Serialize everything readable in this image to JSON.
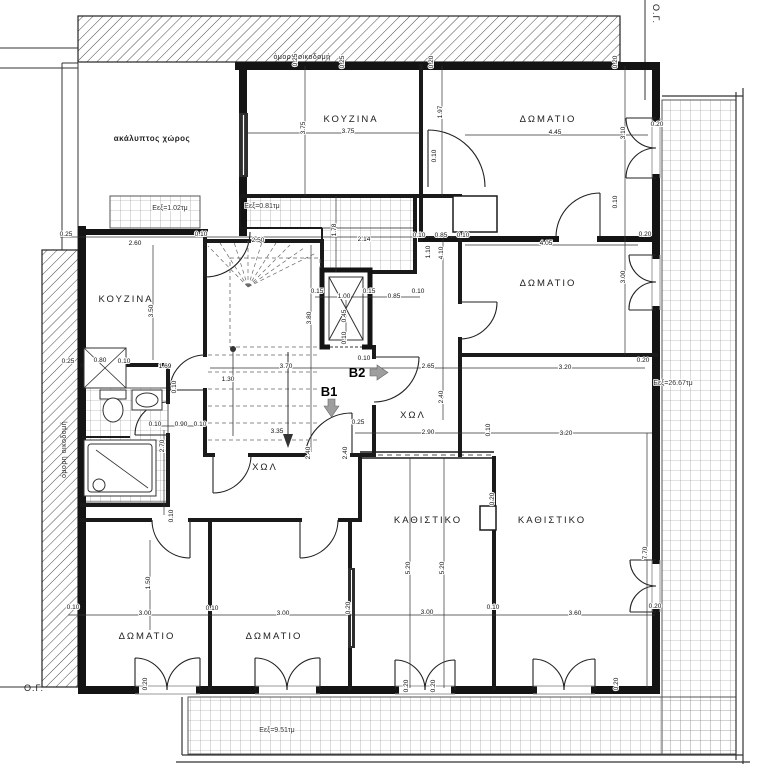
{
  "drawing": {
    "type": "floor-plan"
  },
  "boundary": {
    "og_top_right": "Ο.Γ.",
    "og_bottom_left": "Ο.Γ.",
    "adjacent_top": "όμορη οικοδομή",
    "adjacent_left": "όμορη οικοδομή"
  },
  "markers": {
    "b1": {
      "label": "B1"
    },
    "b2": {
      "label": "B2"
    }
  },
  "rooms": [
    {
      "label": "ακάλυπτος χώρος",
      "x": 152,
      "y": 141,
      "small": true
    },
    {
      "label": "ΚΟΥΖΙΝΑ",
      "x": 351,
      "y": 122
    },
    {
      "label": "ΔΩΜΑΤΙΟ",
      "x": 548,
      "y": 122
    },
    {
      "label": "ΔΩΜΑΤΙΟ",
      "x": 548,
      "y": 286
    },
    {
      "label": "ΚΟΥΖΙΝΑ",
      "x": 126,
      "y": 302
    },
    {
      "label": "ΧΩΛ",
      "x": 265,
      "y": 470
    },
    {
      "label": "ΧΩΛ",
      "x": 413,
      "y": 418
    },
    {
      "label": "ΚΑΘΙΣΤΙΚΟ",
      "x": 428,
      "y": 523
    },
    {
      "label": "ΚΑΘΙΣΤΙΚΟ",
      "x": 552,
      "y": 523
    },
    {
      "label": "ΔΩΜΑΤΙΟ",
      "x": 147,
      "y": 639
    },
    {
      "label": "ΔΩΜΑΤΙΟ",
      "x": 274,
      "y": 639
    }
  ],
  "areas": [
    {
      "label": "Εεξ=1.02τμ",
      "x": 170,
      "y": 210
    },
    {
      "label": "Εεξ=0.81τμ",
      "x": 262,
      "y": 208
    },
    {
      "label": "Εεξ=26.67τμ",
      "x": 673,
      "y": 385
    },
    {
      "label": "Εεξ=9.51τμ",
      "x": 277,
      "y": 732
    }
  ],
  "dimensions": [
    {
      "t": "0.25",
      "x": 66,
      "y": 236
    },
    {
      "t": "2.60",
      "x": 135,
      "y": 245
    },
    {
      "t": "0.10",
      "x": 201,
      "y": 236
    },
    {
      "t": "2.50",
      "x": 258,
      "y": 242
    },
    {
      "t": "2.14",
      "x": 364,
      "y": 241
    },
    {
      "t": "1.78",
      "x": 336,
      "y": 230,
      "r": 1
    },
    {
      "t": "0.10",
      "x": 419,
      "y": 237
    },
    {
      "t": "0.85",
      "x": 441,
      "y": 237
    },
    {
      "t": "0.10",
      "x": 463,
      "y": 237
    },
    {
      "t": "4.05",
      "x": 546,
      "y": 245
    },
    {
      "t": "0.20",
      "x": 645,
      "y": 236
    },
    {
      "t": "3.75",
      "x": 348,
      "y": 133
    },
    {
      "t": "3.75",
      "x": 305,
      "y": 128,
      "r": 1
    },
    {
      "t": "4.45",
      "x": 555,
      "y": 134
    },
    {
      "t": "1.97",
      "x": 442,
      "y": 112,
      "r": 1
    },
    {
      "t": "3.10",
      "x": 625,
      "y": 133,
      "r": 1
    },
    {
      "t": "0.20",
      "x": 657,
      "y": 126
    },
    {
      "t": "0.25",
      "x": 297,
      "y": 60,
      "r": 1
    },
    {
      "t": "0.25",
      "x": 344,
      "y": 62,
      "r": 1
    },
    {
      "t": "0.20",
      "x": 433,
      "y": 62,
      "r": 1
    },
    {
      "t": "0.20",
      "x": 617,
      "y": 62,
      "r": 1
    },
    {
      "t": "0.10",
      "x": 436,
      "y": 156,
      "r": 1
    },
    {
      "t": "0.10",
      "x": 617,
      "y": 202,
      "r": 1
    },
    {
      "t": "1.10",
      "x": 430,
      "y": 252,
      "r": 1
    },
    {
      "t": "4.10",
      "x": 443,
      "y": 253,
      "r": 1
    },
    {
      "t": "3.50",
      "x": 153,
      "y": 311,
      "r": 1
    },
    {
      "t": "3.80",
      "x": 311,
      "y": 318,
      "r": 1
    },
    {
      "t": "0.15",
      "x": 317,
      "y": 293
    },
    {
      "t": "1.00",
      "x": 344,
      "y": 298
    },
    {
      "t": "0.15",
      "x": 369,
      "y": 293
    },
    {
      "t": "0.85",
      "x": 394,
      "y": 298
    },
    {
      "t": "0.10",
      "x": 418,
      "y": 293
    },
    {
      "t": "0.45",
      "x": 346,
      "y": 316,
      "r": 1
    },
    {
      "t": "0.10",
      "x": 346,
      "y": 338,
      "r": 1
    },
    {
      "t": "3.00",
      "x": 625,
      "y": 277,
      "r": 1
    },
    {
      "t": "0.25",
      "x": 68,
      "y": 363
    },
    {
      "t": "0.80",
      "x": 100,
      "y": 362
    },
    {
      "t": "0.10",
      "x": 124,
      "y": 363
    },
    {
      "t": "1.69",
      "x": 165,
      "y": 368
    },
    {
      "t": "0.10",
      "x": 176,
      "y": 387,
      "r": 1
    },
    {
      "t": "1.30",
      "x": 228,
      "y": 381
    },
    {
      "t": "3.70",
      "x": 286,
      "y": 368
    },
    {
      "t": "0.10",
      "x": 364,
      "y": 360
    },
    {
      "t": "2.65",
      "x": 428,
      "y": 368
    },
    {
      "t": "3.20",
      "x": 565,
      "y": 369
    },
    {
      "t": "2.40",
      "x": 443,
      "y": 397,
      "r": 1
    },
    {
      "t": "0.20",
      "x": 643,
      "y": 362
    },
    {
      "t": "0.10",
      "x": 155,
      "y": 426
    },
    {
      "t": "0.90",
      "x": 181,
      "y": 426
    },
    {
      "t": "0.10",
      "x": 200,
      "y": 426
    },
    {
      "t": "3.35",
      "x": 277,
      "y": 433
    },
    {
      "t": "2.70",
      "x": 164,
      "y": 446,
      "r": 1
    },
    {
      "t": "2.40",
      "x": 310,
      "y": 453,
      "r": 1
    },
    {
      "t": "2.40",
      "x": 347,
      "y": 453,
      "r": 1
    },
    {
      "t": "2.90",
      "x": 428,
      "y": 434
    },
    {
      "t": "0.10",
      "x": 490,
      "y": 430,
      "r": 1
    },
    {
      "t": "3.20",
      "x": 566,
      "y": 435
    },
    {
      "t": "0.25",
      "x": 358,
      "y": 424
    },
    {
      "t": "0.10",
      "x": 173,
      "y": 516,
      "r": 1
    },
    {
      "t": "0.20",
      "x": 494,
      "y": 499,
      "r": 1
    },
    {
      "t": "1.50",
      "x": 150,
      "y": 583,
      "r": 1
    },
    {
      "t": "5.20",
      "x": 410,
      "y": 568,
      "r": 1
    },
    {
      "t": "5.20",
      "x": 444,
      "y": 568,
      "r": 1
    },
    {
      "t": "7.70",
      "x": 647,
      "y": 553,
      "r": 1
    },
    {
      "t": "0.10",
      "x": 73,
      "y": 609
    },
    {
      "t": "3.00",
      "x": 145,
      "y": 615
    },
    {
      "t": "0.10",
      "x": 212,
      "y": 610
    },
    {
      "t": "3.00",
      "x": 283,
      "y": 615
    },
    {
      "t": "0.20",
      "x": 350,
      "y": 608,
      "r": 1
    },
    {
      "t": "3.00",
      "x": 427,
      "y": 614
    },
    {
      "t": "0.10",
      "x": 493,
      "y": 609
    },
    {
      "t": "3.60",
      "x": 575,
      "y": 615
    },
    {
      "t": "0.20",
      "x": 655,
      "y": 608
    },
    {
      "t": "0.20",
      "x": 147,
      "y": 684,
      "r": 1
    },
    {
      "t": "0.20",
      "x": 408,
      "y": 686,
      "r": 1
    },
    {
      "t": "0.20",
      "x": 435,
      "y": 686,
      "r": 1
    },
    {
      "t": "0.20",
      "x": 618,
      "y": 684,
      "r": 1
    }
  ]
}
